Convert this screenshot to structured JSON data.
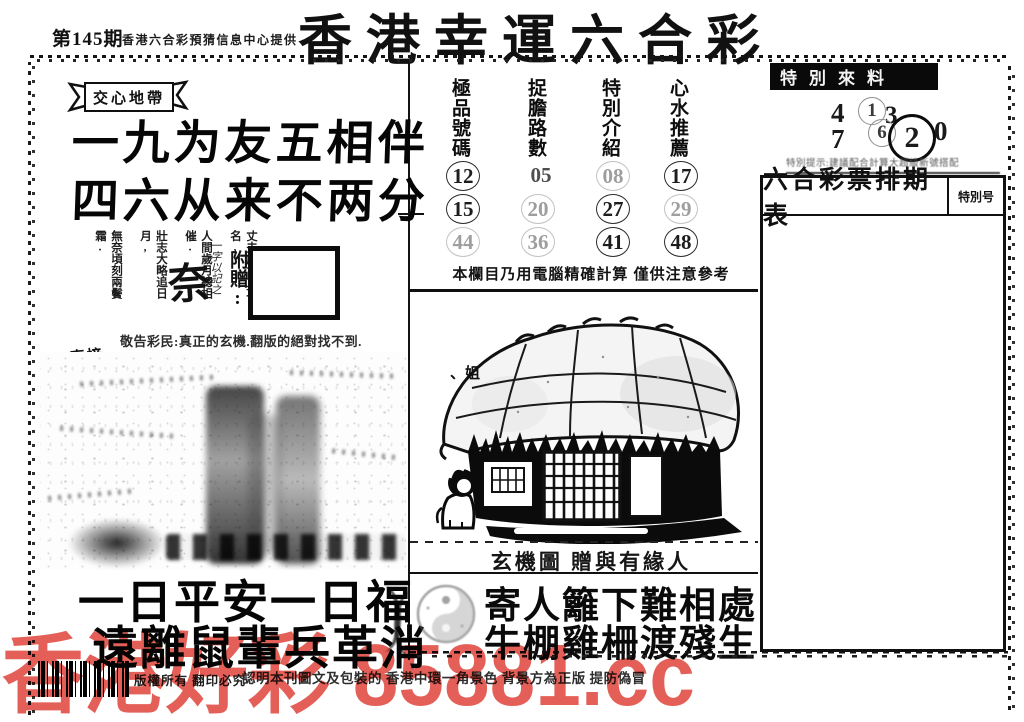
{
  "colors": {
    "ink": "#111111",
    "paper": "#ffffff",
    "watermark_red": "#e0493f"
  },
  "header": {
    "issue": "第145期",
    "provider": "香港六合彩預猜信息中心提供",
    "title": "香港幸運六合彩"
  },
  "left_panel": {
    "ribbon_label": "交心地帶",
    "couplet": [
      "一九为友五相伴",
      "四六从来不两分"
    ],
    "poem_columns": [
      "無奈頃刻兩鬢霜.",
      "壯志大略追日月,",
      "人間歲月總相催.",
      "丈夫處世立功名,"
    ],
    "summary_char": "奈",
    "summary_note": "一字以記之",
    "gift_label": "附贈:",
    "advisory": "敬告彩民:真正的玄機.翻版的絕對找不到.",
    "stamp_top": "直接",
    "stamp_bottom": "說",
    "bottom_couplet": [
      "一日平安一日福",
      "遠離鼠輩兵革消"
    ]
  },
  "tips_board": {
    "columns": [
      {
        "header": "極品號碼",
        "numbers": [
          {
            "v": "12",
            "style": "solid"
          },
          {
            "v": "15",
            "style": "solid"
          },
          {
            "v": "44",
            "style": "faint"
          }
        ]
      },
      {
        "header": "捉膽路數",
        "numbers": [
          {
            "v": "05",
            "style": "plain"
          },
          {
            "v": "20",
            "style": "faint"
          },
          {
            "v": "36",
            "style": "faint"
          }
        ]
      },
      {
        "header": "特別介紹",
        "numbers": [
          {
            "v": "08",
            "style": "faint"
          },
          {
            "v": "27",
            "style": "solid"
          },
          {
            "v": "41",
            "style": "solid"
          }
        ]
      },
      {
        "header": "心水推薦",
        "numbers": [
          {
            "v": "17",
            "style": "solid"
          },
          {
            "v": "29",
            "style": "faint"
          },
          {
            "v": "48",
            "style": "solid"
          }
        ]
      }
    ],
    "computer_note": "本欄目乃用電腦精確計算 僅供注意參考"
  },
  "mystery": {
    "roof_label": "、姐",
    "caption": "玄機圖 贈與有緣人",
    "couplet": [
      "寄人籬下難相處",
      "牛棚雞柵渡殘生"
    ]
  },
  "special": {
    "banner": "特別來料",
    "digits": [
      {
        "v": "4",
        "circle": "none"
      },
      {
        "v": "7",
        "circle": "none"
      },
      {
        "v": "1",
        "circle": "faint"
      },
      {
        "v": "3",
        "circle": "none"
      },
      {
        "v": "6",
        "circle": "faint"
      },
      {
        "v": "2",
        "circle": "bold"
      },
      {
        "v": "0",
        "circle": "none"
      }
    ],
    "tip_note": "特別提示:建議配合計算大超級新號搭配",
    "schedule_title": "六合彩票排期表",
    "schedule_corner": "特別号"
  },
  "footer": {
    "copyright": "版權所有 翻印必究",
    "authenticity": "認明本刊圖文及包裝的 香港中環一角景色 背景方為正版 提防偽冒",
    "watermark": "香港好彩 85881.cc"
  }
}
